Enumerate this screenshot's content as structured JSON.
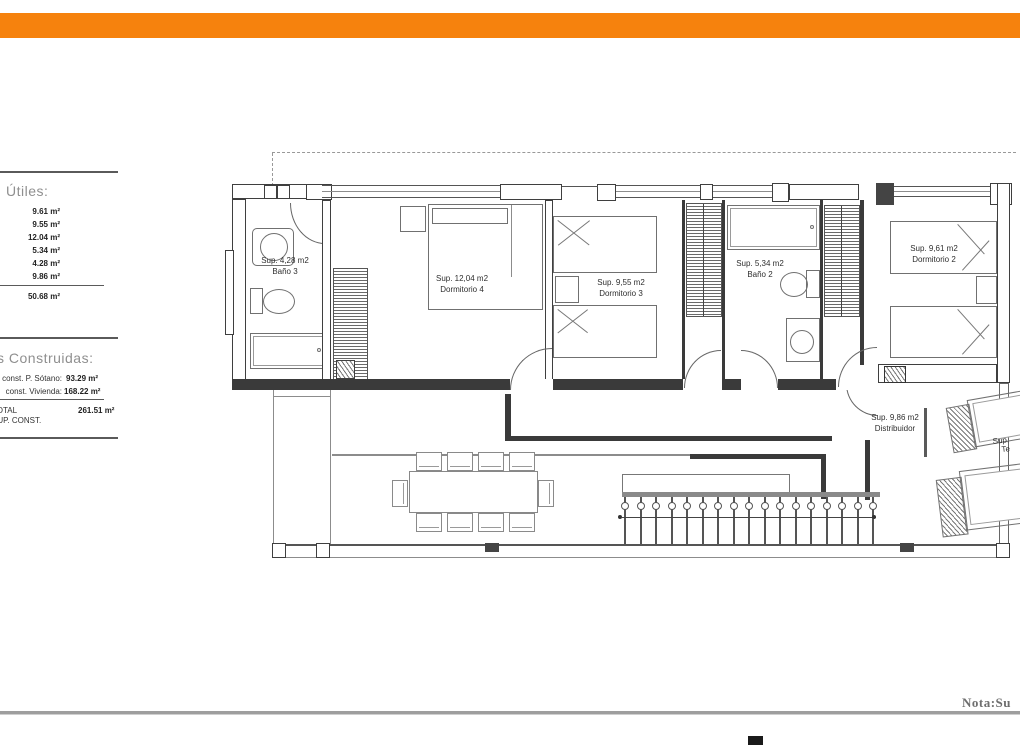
{
  "colors": {
    "header_bar": "#f6820d"
  },
  "sidebar": {
    "useful": {
      "title": "Útiles:",
      "values": [
        "9.61 m²",
        "9.55 m²",
        "12.04 m²",
        "5.34 m²",
        "4.28 m²",
        "9.86 m²"
      ],
      "total": "50.68 m²"
    },
    "built": {
      "title": "s Construidas:",
      "rows": [
        {
          "label": "const. P. Sótano:",
          "value": "93.29 m²"
        },
        {
          "label": "const. Vivienda:",
          "value": "168.22 m²"
        }
      ],
      "total_label_1": "TOTAL",
      "total_label_2": "SUP. CONST.",
      "total_value": "261.51 m²"
    }
  },
  "plan": {
    "rooms": {
      "bano3": {
        "area": "Sup. 4,28 m2",
        "name": "Baño 3"
      },
      "dorm4": {
        "area": "Sup. 12,04 m2",
        "name": "Dormitorio 4"
      },
      "dorm3": {
        "area": "Sup. 9,55 m2",
        "name": "Dormitorio 3"
      },
      "bano2": {
        "area": "Sup. 5,34 m2",
        "name": "Baño 2"
      },
      "dorm2": {
        "area": "Sup. 9,61 m2",
        "name": "Dormitorio 2"
      },
      "distribuidor": {
        "area": "Sup. 9,86 m2",
        "name": "Distribuidor"
      },
      "terraza": {
        "line1": "Sup.",
        "line2": "Te"
      }
    }
  },
  "footer": {
    "note": "Nota:Su"
  }
}
